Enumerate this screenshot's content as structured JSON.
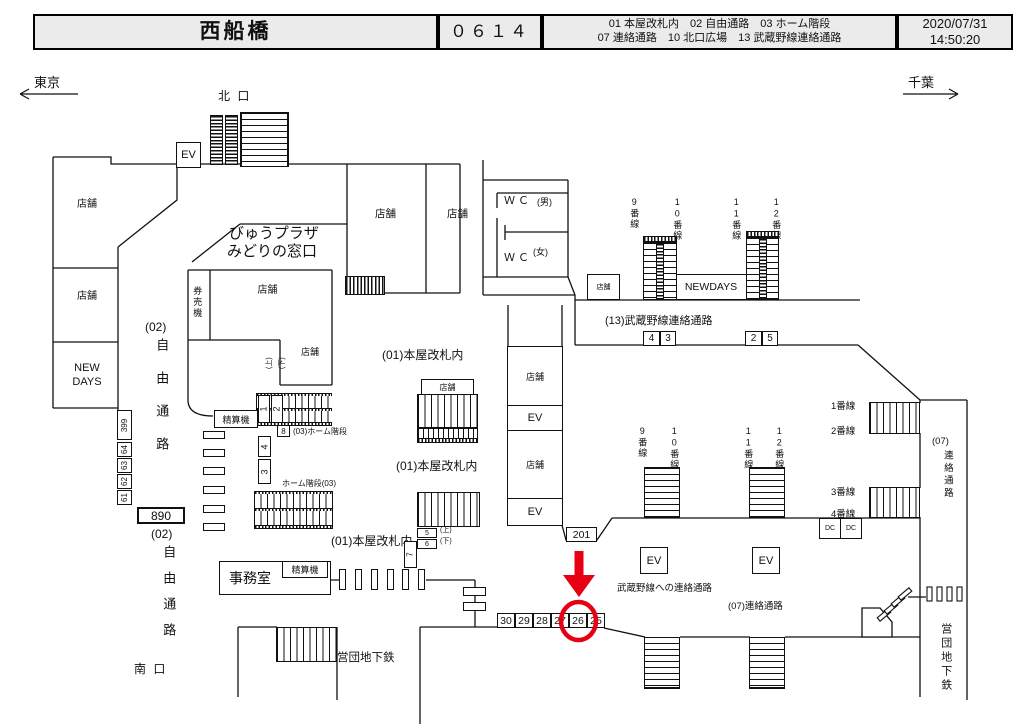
{
  "header": {
    "station_name": "西船橋",
    "location_code": "０６１４",
    "legend_line1": "01 本屋改札内　02 自由通路　03 ホーム階段",
    "legend_line2": "07 連絡通路　10 北口広場　13 武蔵野線連絡通路",
    "date": "2020/07/31",
    "time": "14:50:20"
  },
  "directions": {
    "west": "東京",
    "east": "千葉"
  },
  "exits": {
    "north": "北 口",
    "south": "南 口"
  },
  "common": {
    "shop": "店舗",
    "elevator": "EV",
    "fare_adjustment": "精算機",
    "ticket_machines": "券売機",
    "office": "事務室",
    "newdays": "NEWDAYS",
    "new_days": "NEW\nDAYS",
    "view_plaza": "びゅうプラザ",
    "midori_window": "みどりの窓口",
    "wc": "ＷＣ",
    "men": "(男)",
    "women": "(女)",
    "up": "(上)",
    "down": "(下)",
    "subway": "営団地下鉄"
  },
  "areas": {
    "inside_main_gate": "(01)本屋改札内",
    "free_passage_code": "(02)",
    "free_passage": "自由通路",
    "platform_stair_a": "(03)ホーム階段",
    "platform_stair_b": "ホーム階段(03)",
    "musashino_corridor": "(13)武蔵野線連絡通路",
    "musashino_link": "武蔵野線への連絡通路",
    "corridor07_code": "(07)",
    "corridor07_name": "連絡通路",
    "corridor07_full": "(07)連絡通路"
  },
  "platforms": {
    "p9": "9番線",
    "p10": "10番線",
    "p11": "11番線",
    "p12": "12番線",
    "p1": "1番線",
    "p2": "2番線",
    "p3": "3番線",
    "p4": "4番線"
  },
  "ad_positions": {
    "left_column": [
      "399",
      "64",
      "63",
      "62",
      "61"
    ],
    "box_890": "890",
    "box_201": "201",
    "south_row": [
      "30",
      "29",
      "28",
      "27",
      "26",
      "25"
    ],
    "corridor13_left": [
      "4",
      "3"
    ],
    "corridor13_right": [
      "2",
      "5"
    ],
    "stair_pair_12": [
      "1",
      "2"
    ],
    "stair_pair_43": [
      "4",
      "3"
    ],
    "gate_boxes": [
      "5",
      "6",
      "7",
      "8"
    ],
    "dc": "DC",
    "highlighted_position": "26"
  }
}
